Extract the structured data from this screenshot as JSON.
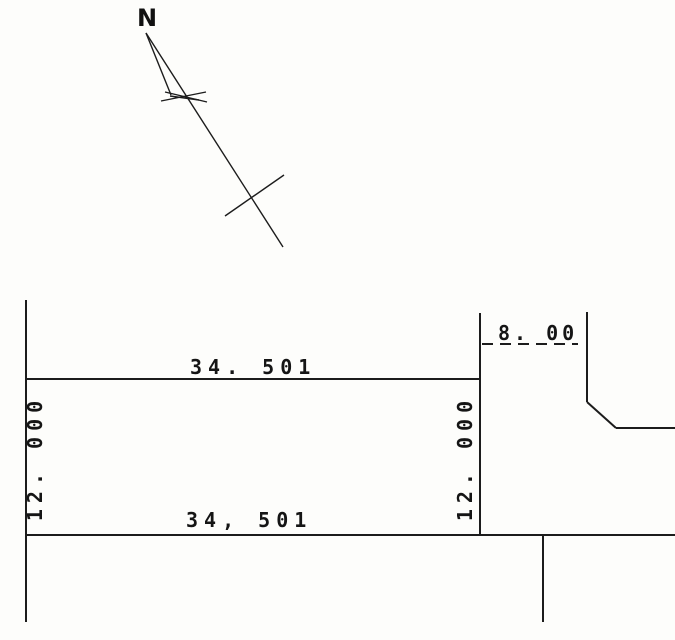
{
  "page": {
    "type": "survey-plat-scan",
    "background_color": "#fdfdfb",
    "line_color": "#1c1c1c",
    "text_color": "#151515"
  },
  "north_arrow": {
    "label": "N"
  },
  "dimensions": {
    "parcel_top_width": "34. 501",
    "parcel_bottom_width": "34, 501",
    "parcel_left_height": "12. 000",
    "parcel_right_height": "12. 000",
    "adjacent_top_width": "8. 00"
  }
}
